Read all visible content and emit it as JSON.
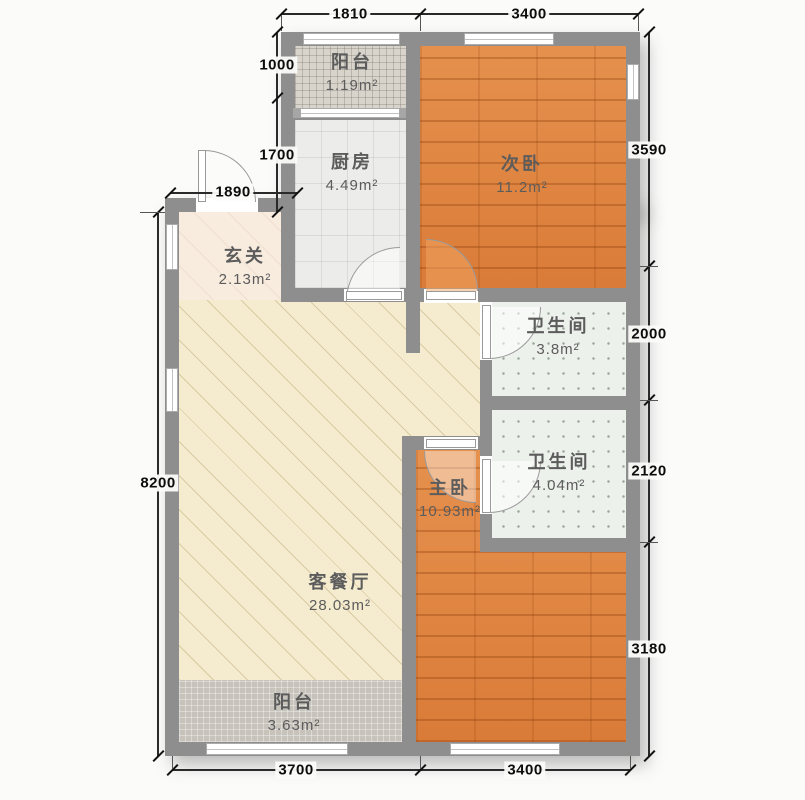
{
  "plan": {
    "type": "apartment-floor-plan",
    "rooms": {
      "balcony_top": {
        "name": "阳台",
        "area": "1.19m²"
      },
      "kitchen": {
        "name": "厨房",
        "area": "4.49m²"
      },
      "bedroom_second": {
        "name": "次卧",
        "area": "11.2m²"
      },
      "entry": {
        "name": "玄关",
        "area": "2.13m²"
      },
      "bath_upper": {
        "name": "卫生间",
        "area": "3.8m²"
      },
      "bath_lower": {
        "name": "卫生间",
        "area": "4.04m²"
      },
      "bedroom_master": {
        "name": "主卧",
        "area": "10.93m²"
      },
      "living_dining": {
        "name": "客餐厅",
        "area": "28.03m²"
      },
      "balcony_bottom": {
        "name": "阳台",
        "area": "3.63m²"
      }
    },
    "dimensions_mm": {
      "top_1": "1810",
      "top_2": "3400",
      "left_1": "1000",
      "left_2": "1700",
      "left_3": "1890",
      "left_4": "8200",
      "right_1": "3590",
      "right_2": "2000",
      "right_3": "2120",
      "right_4": "3180",
      "bottom_1": "3700",
      "bottom_2": "3400"
    },
    "colors": {
      "wall": "#8e8e8e",
      "wood_floor": "#e0813e",
      "living_floor": "#f5eccf",
      "kitchen_tile": "#ececea",
      "bath_tile": "#edf1ec",
      "balcony_top_tile": "#d8d4cc",
      "balcony_bottom_tile": "#c7c3bb",
      "dimension_text": "#0d0d0d"
    }
  }
}
